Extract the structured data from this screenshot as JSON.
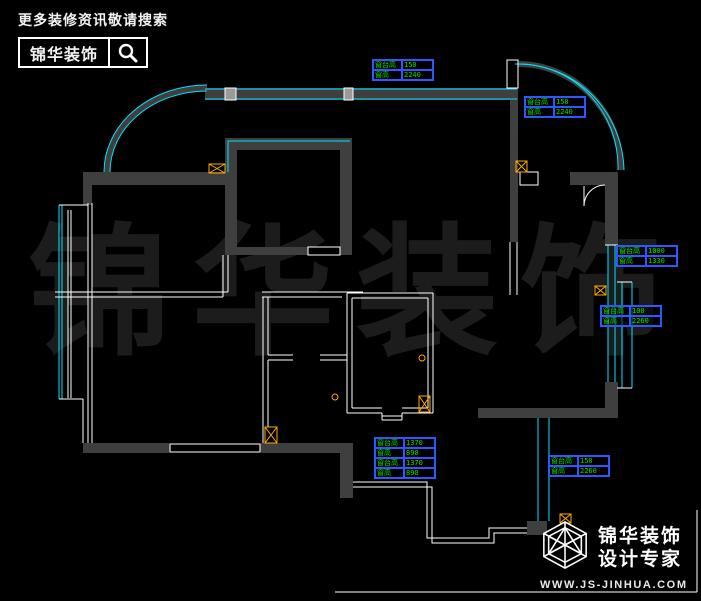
{
  "header": {
    "tagline": "更多装修资讯敬请搜索",
    "brand": "锦华装饰"
  },
  "watermark": {
    "text": "锦华装饰"
  },
  "annotations": [
    {
      "rows": [
        {
          "label": "窗台高",
          "value": "150"
        },
        {
          "label": "窗高",
          "value": "2240"
        }
      ]
    },
    {
      "rows": [
        {
          "label": "窗台高",
          "value": "150"
        },
        {
          "label": "窗高",
          "value": "2240"
        }
      ]
    },
    {
      "rows": [
        {
          "label": "窗台高",
          "value": "1000"
        },
        {
          "label": "窗高",
          "value": "1330"
        }
      ]
    },
    {
      "rows": [
        {
          "label": "窗台高",
          "value": "100"
        },
        {
          "label": "窗高",
          "value": "2260"
        }
      ]
    },
    {
      "rows": [
        {
          "label": "窗台高",
          "value": "1370"
        },
        {
          "label": "窗高",
          "value": "890"
        },
        {
          "label": "窗台高",
          "value": "1370"
        },
        {
          "label": "窗高",
          "value": "890"
        }
      ]
    },
    {
      "rows": [
        {
          "label": "窗台高",
          "value": "150"
        },
        {
          "label": "窗高",
          "value": "2260"
        }
      ]
    }
  ],
  "footer": {
    "brand": "锦华装饰",
    "subtitle": "设计专家",
    "website": "WWW.JS-JINHUA.COM"
  },
  "colors": {
    "background": "#000000",
    "wall": "#3f3f3f",
    "window_glass": "#00e5ff",
    "partition": "#ffffff",
    "annotation_text": "#00e800",
    "annotation_border": "#2b59ff",
    "column": "#ffaa00",
    "watermark": "#1c1c1c"
  }
}
